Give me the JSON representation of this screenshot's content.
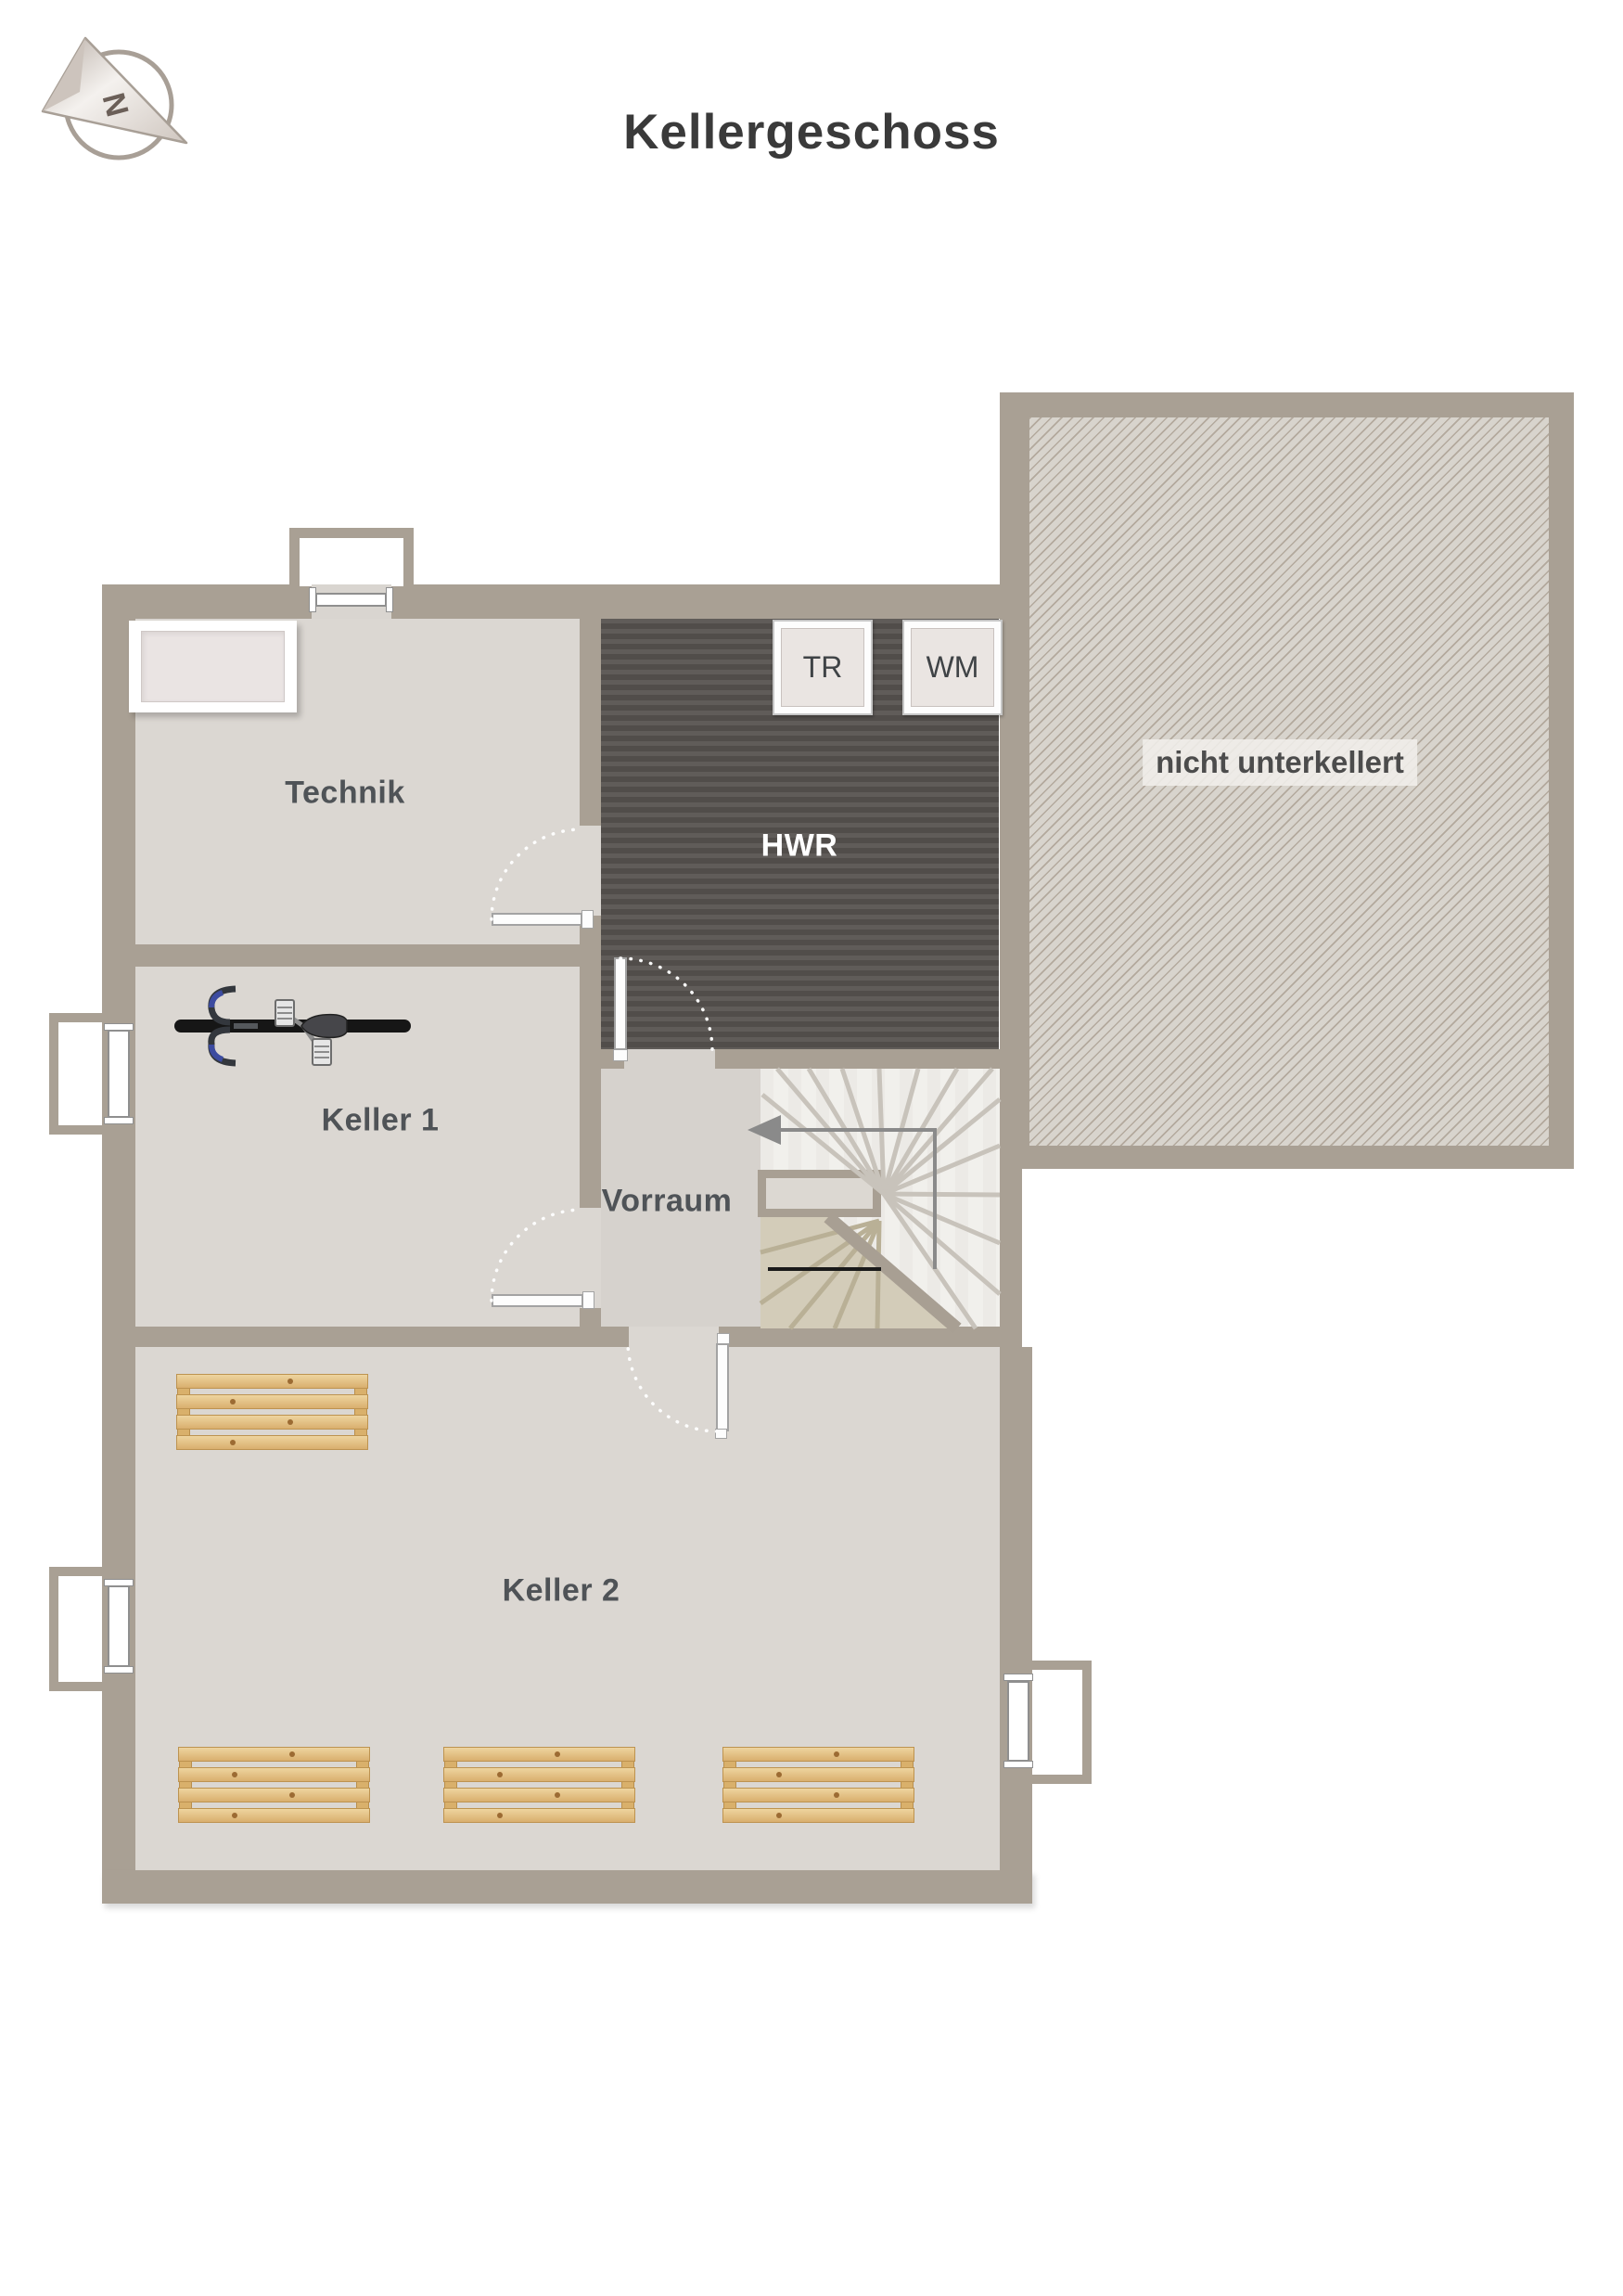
{
  "title": "Kellergeschoss",
  "compass": {
    "direction_letter": "N"
  },
  "plan": {
    "rooms": [
      {
        "id": "technik",
        "label": "Technik"
      },
      {
        "id": "hwr",
        "label": "HWR"
      },
      {
        "id": "keller1",
        "label": "Keller 1"
      },
      {
        "id": "vorraum",
        "label": "Vorraum"
      },
      {
        "id": "keller2",
        "label": "Keller 2"
      }
    ],
    "area_note": "nicht unterkellert",
    "appliances": [
      {
        "id": "tr",
        "label": "TR"
      },
      {
        "id": "wm",
        "label": "WM"
      }
    ]
  },
  "colors": {
    "wall": "#a9a094",
    "floor": "#dbd7d2",
    "floor_vorraum": "#d6d2cd",
    "hwr_floor": "#575350",
    "stair_floor": "#f1efeb",
    "hatch_line": "#b3a99d",
    "wood_plank": "#e3bf85",
    "label_text": "#4f5357",
    "title_text": "#3a3a3a"
  }
}
